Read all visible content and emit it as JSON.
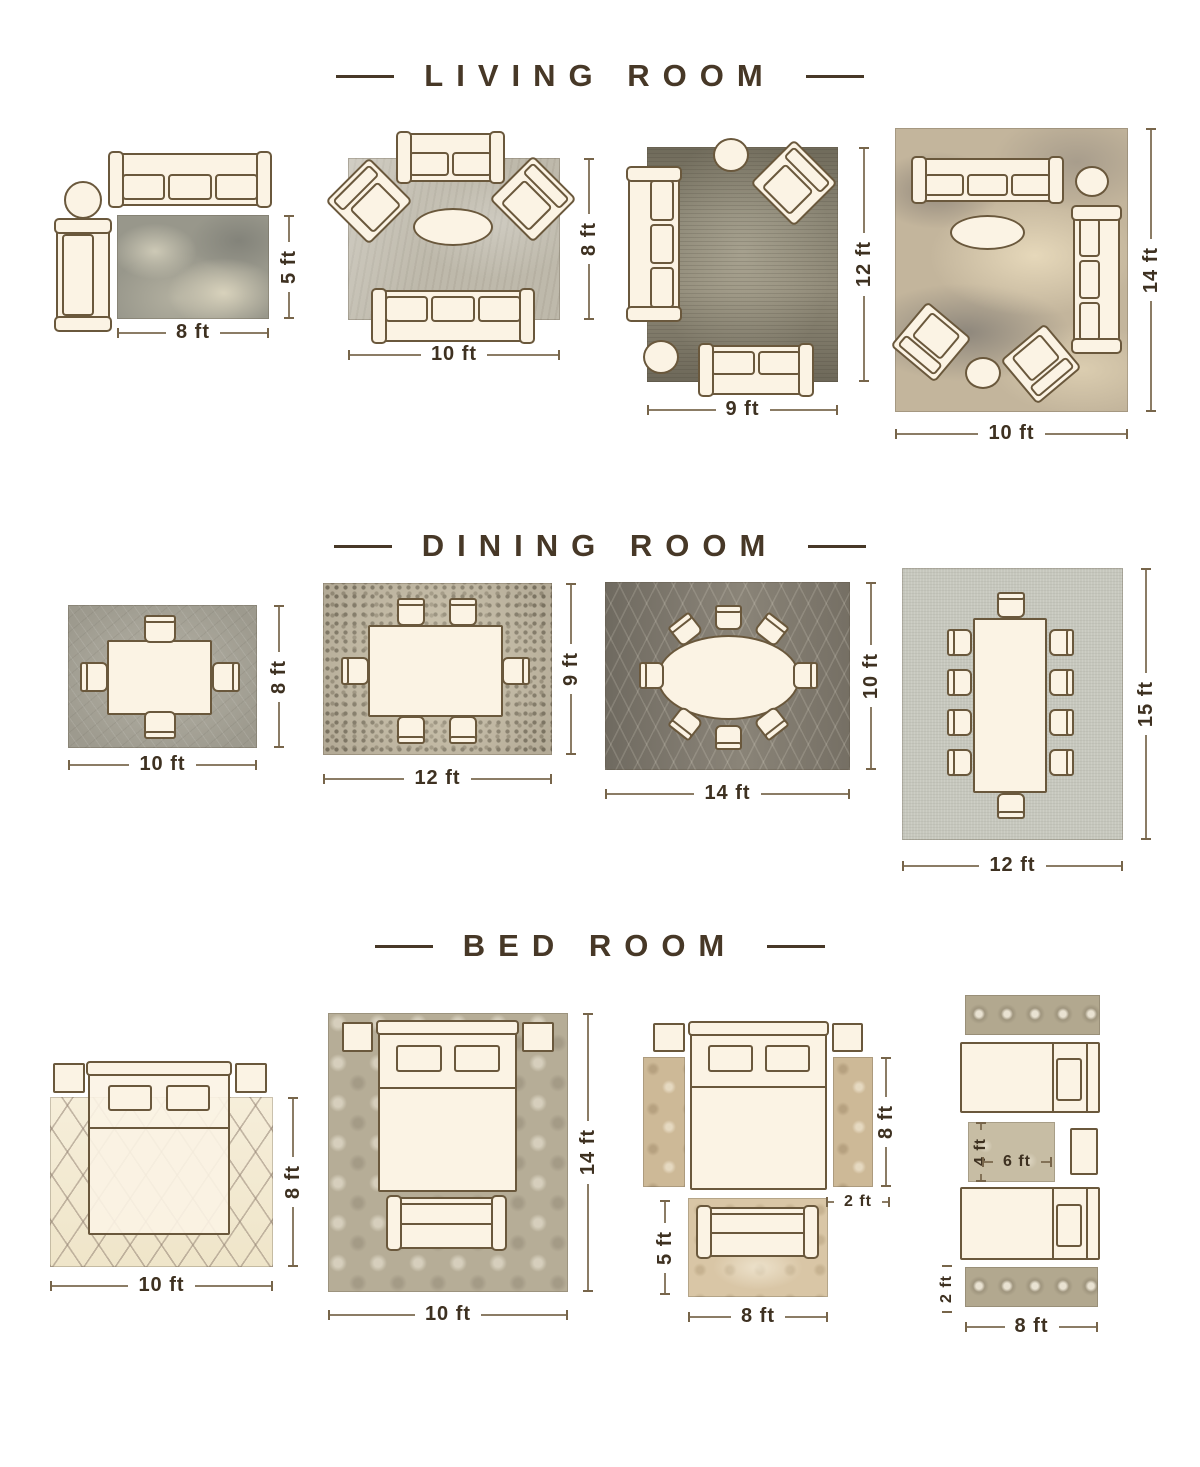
{
  "sections": {
    "living": {
      "title": "LIVING ROOM",
      "layouts": {
        "l1": {
          "width": "8 ft",
          "height": "5 ft"
        },
        "l2": {
          "width": "10 ft",
          "height": "8 ft"
        },
        "l3": {
          "width": "9 ft",
          "height": "12 ft"
        },
        "l4": {
          "width": "10 ft",
          "height": "14 ft"
        }
      }
    },
    "dining": {
      "title": "DINING ROOM",
      "layouts": {
        "d1": {
          "width": "10 ft",
          "height": "8 ft"
        },
        "d2": {
          "width": "12 ft",
          "height": "9 ft"
        },
        "d3": {
          "width": "14 ft",
          "height": "10 ft"
        },
        "d4": {
          "width": "12 ft",
          "height": "15 ft"
        }
      }
    },
    "bedroom": {
      "title": "BED ROOM",
      "layouts": {
        "b1": {
          "width": "10 ft",
          "height": "8 ft"
        },
        "b2": {
          "width": "10 ft",
          "height": "14 ft"
        },
        "b3": {
          "bed_height": "8 ft",
          "runner_width": "2 ft",
          "rug_height": "5 ft",
          "rug_width": "8 ft"
        },
        "b4": {
          "mid_height": "4 ft",
          "mid_width": "6 ft",
          "runner_height": "2 ft",
          "runner_width": "8 ft"
        }
      }
    }
  }
}
